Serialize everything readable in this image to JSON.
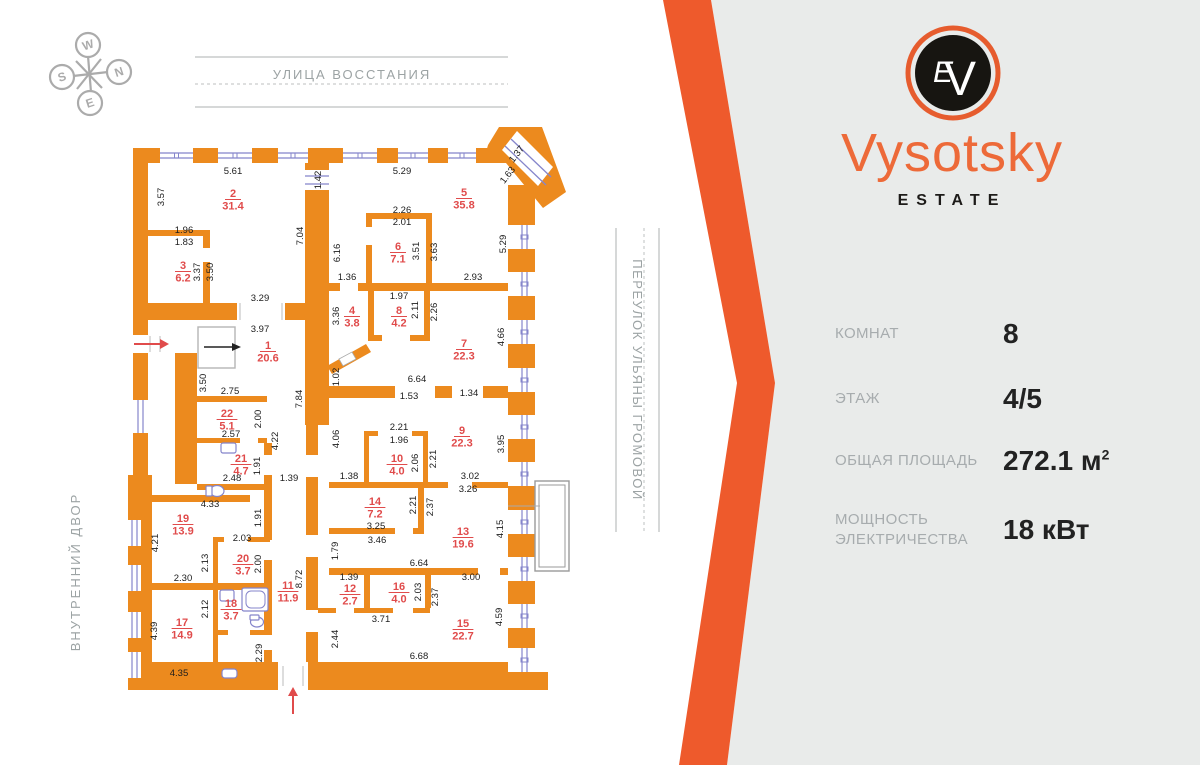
{
  "compass": {
    "letters": [
      "W",
      "N",
      "S",
      "E"
    ]
  },
  "streets": {
    "top": "УЛИЦА ВОССТАНИЯ",
    "right": "ПЕРЕУЛОК УЛЬЯНЫ ГРОМОВОЙ",
    "left": "ВНУТРЕННИЙ ДВОР"
  },
  "brand": {
    "name": "Vysotsky",
    "subtitle": "ESTATE",
    "monogram_v": "V",
    "monogram_e": "E"
  },
  "info": {
    "rows": [
      {
        "label": "КОМНАТ",
        "value": "8",
        "sup": ""
      },
      {
        "label": "ЭТАЖ",
        "value": "4/5",
        "sup": ""
      },
      {
        "label": "ОБЩАЯ ПЛОЩАДЬ",
        "value": "272.1 м",
        "sup": "2"
      },
      {
        "label": "МОЩНОСТЬ ЭЛЕКТРИЧЕСТВА",
        "value": "18 кВт",
        "sup": ""
      }
    ]
  },
  "colors": {
    "wall_orange": "#EC8A1E",
    "chevron_orange": "#EE5A2C",
    "brand_orange": "#ED6A39",
    "panel_gray": "#E9EBEA",
    "room_red": "#E04B4B",
    "window_blue": "#8585CB",
    "muted_gray": "#9CA3A4"
  },
  "plan": {
    "rooms": [
      {
        "n": "1",
        "area": "20.6",
        "x": 268,
        "y": 349
      },
      {
        "n": "2",
        "area": "31.4",
        "x": 233,
        "y": 197
      },
      {
        "n": "3",
        "area": "6.2",
        "x": 183,
        "y": 269
      },
      {
        "n": "4",
        "area": "3.8",
        "x": 352,
        "y": 314
      },
      {
        "n": "5",
        "area": "35.8",
        "x": 464,
        "y": 196
      },
      {
        "n": "6",
        "area": "7.1",
        "x": 398,
        "y": 250
      },
      {
        "n": "7",
        "area": "22.3",
        "x": 464,
        "y": 347
      },
      {
        "n": "8",
        "area": "4.2",
        "x": 399,
        "y": 314
      },
      {
        "n": "9",
        "area": "22.3",
        "x": 462,
        "y": 434
      },
      {
        "n": "10",
        "area": "4.0",
        "x": 397,
        "y": 462
      },
      {
        "n": "11",
        "area": "11.9",
        "x": 288,
        "y": 589
      },
      {
        "n": "12",
        "area": "2.7",
        "x": 350,
        "y": 592
      },
      {
        "n": "13",
        "area": "19.6",
        "x": 463,
        "y": 535
      },
      {
        "n": "14",
        "area": "7.2",
        "x": 375,
        "y": 505
      },
      {
        "n": "15",
        "area": "22.7",
        "x": 463,
        "y": 627
      },
      {
        "n": "16",
        "area": "4.0",
        "x": 399,
        "y": 590
      },
      {
        "n": "17",
        "area": "14.9",
        "x": 182,
        "y": 626
      },
      {
        "n": "18",
        "area": "3.7",
        "x": 231,
        "y": 607
      },
      {
        "n": "19",
        "area": "13.9",
        "x": 183,
        "y": 522
      },
      {
        "n": "20",
        "area": "3.7",
        "x": 243,
        "y": 562
      },
      {
        "n": "21",
        "area": "4.7",
        "x": 241,
        "y": 462
      },
      {
        "n": "22",
        "area": "5.1",
        "x": 227,
        "y": 417
      }
    ],
    "dims": [
      {
        "t": "5.61",
        "x": 233,
        "y": 174
      },
      {
        "t": "3.57",
        "x": 164,
        "y": 197,
        "r": -90
      },
      {
        "t": "1.42",
        "x": 321,
        "y": 180,
        "r": -90
      },
      {
        "t": "5.29",
        "x": 402,
        "y": 174
      },
      {
        "t": "1.37",
        "x": 519,
        "y": 156,
        "r": -52
      },
      {
        "t": "1.63",
        "x": 510,
        "y": 177,
        "r": -52
      },
      {
        "t": "2.26",
        "x": 402,
        "y": 213
      },
      {
        "t": "2.01",
        "x": 402,
        "y": 225
      },
      {
        "t": "5.29",
        "x": 506,
        "y": 244,
        "r": -90
      },
      {
        "t": "1.96",
        "x": 184,
        "y": 233
      },
      {
        "t": "1.83",
        "x": 184,
        "y": 245
      },
      {
        "t": "6.16",
        "x": 340,
        "y": 253,
        "r": -90
      },
      {
        "t": "7.04",
        "x": 303,
        "y": 236,
        "r": -90
      },
      {
        "t": "3.51",
        "x": 419,
        "y": 251,
        "r": -90
      },
      {
        "t": "3.63",
        "x": 437,
        "y": 252,
        "r": -90
      },
      {
        "t": "3.37",
        "x": 200,
        "y": 272,
        "r": -90
      },
      {
        "t": "3.50",
        "x": 213,
        "y": 272,
        "r": -90
      },
      {
        "t": "1.36",
        "x": 347,
        "y": 280
      },
      {
        "t": "2.93",
        "x": 473,
        "y": 280
      },
      {
        "t": "1.97",
        "x": 399,
        "y": 299
      },
      {
        "t": "3.29",
        "x": 260,
        "y": 301
      },
      {
        "t": "3.97",
        "x": 260,
        "y": 332
      },
      {
        "t": "3.36",
        "x": 339,
        "y": 316,
        "r": -90
      },
      {
        "t": "2.11",
        "x": 418,
        "y": 310,
        "r": -90
      },
      {
        "t": "2.26",
        "x": 437,
        "y": 312,
        "r": -90
      },
      {
        "t": "4.66",
        "x": 504,
        "y": 337,
        "r": -90
      },
      {
        "t": "1.02",
        "x": 339,
        "y": 377,
        "r": -90
      },
      {
        "t": "6.64",
        "x": 417,
        "y": 382
      },
      {
        "t": "1.53",
        "x": 409,
        "y": 399
      },
      {
        "t": "1.34",
        "x": 469,
        "y": 396
      },
      {
        "t": "3.50",
        "x": 206,
        "y": 383,
        "r": -90
      },
      {
        "t": "7.84",
        "x": 302,
        "y": 399,
        "r": -90
      },
      {
        "t": "2.75",
        "x": 230,
        "y": 394
      },
      {
        "t": "2.00",
        "x": 261,
        "y": 419,
        "r": -90
      },
      {
        "t": "2.57",
        "x": 231,
        "y": 437
      },
      {
        "t": "4.22",
        "x": 278,
        "y": 441,
        "r": -90
      },
      {
        "t": "4.06",
        "x": 339,
        "y": 439,
        "r": -90
      },
      {
        "t": "2.21",
        "x": 399,
        "y": 430
      },
      {
        "t": "1.96",
        "x": 399,
        "y": 443
      },
      {
        "t": "3.95",
        "x": 504,
        "y": 444,
        "r": -90
      },
      {
        "t": "2.06",
        "x": 418,
        "y": 463,
        "r": -90
      },
      {
        "t": "2.21",
        "x": 436,
        "y": 459,
        "r": -90
      },
      {
        "t": "1.91",
        "x": 260,
        "y": 466,
        "r": -90
      },
      {
        "t": "2.48",
        "x": 232,
        "y": 481
      },
      {
        "t": "1.39",
        "x": 289,
        "y": 481
      },
      {
        "t": "1.38",
        "x": 349,
        "y": 479
      },
      {
        "t": "3.02",
        "x": 470,
        "y": 479
      },
      {
        "t": "3.26",
        "x": 468,
        "y": 492
      },
      {
        "t": "4.33",
        "x": 210,
        "y": 507
      },
      {
        "t": "1.91",
        "x": 261,
        "y": 518,
        "r": -90
      },
      {
        "t": "2.21",
        "x": 416,
        "y": 505,
        "r": -90
      },
      {
        "t": "2.37",
        "x": 433,
        "y": 507,
        "r": -90
      },
      {
        "t": "4.15",
        "x": 503,
        "y": 529,
        "r": -90
      },
      {
        "t": "4.21",
        "x": 158,
        "y": 543,
        "r": -90
      },
      {
        "t": "2.03",
        "x": 242,
        "y": 541
      },
      {
        "t": "2.13",
        "x": 208,
        "y": 563,
        "r": -90
      },
      {
        "t": "2.00",
        "x": 261,
        "y": 564,
        "r": -90
      },
      {
        "t": "3.25",
        "x": 376,
        "y": 529
      },
      {
        "t": "3.46",
        "x": 377,
        "y": 543
      },
      {
        "t": "1.79",
        "x": 338,
        "y": 551,
        "r": -90
      },
      {
        "t": "2.30",
        "x": 183,
        "y": 581
      },
      {
        "t": "8.72",
        "x": 302,
        "y": 579,
        "r": -90
      },
      {
        "t": "6.64",
        "x": 419,
        "y": 566
      },
      {
        "t": "1.39",
        "x": 349,
        "y": 580
      },
      {
        "t": "3.00",
        "x": 471,
        "y": 580
      },
      {
        "t": "2.03",
        "x": 421,
        "y": 592,
        "r": -90
      },
      {
        "t": "2.37",
        "x": 438,
        "y": 597,
        "r": -90
      },
      {
        "t": "2.12",
        "x": 208,
        "y": 609,
        "r": -90
      },
      {
        "t": "4.39",
        "x": 157,
        "y": 631,
        "r": -90
      },
      {
        "t": "4.59",
        "x": 502,
        "y": 617,
        "r": -90
      },
      {
        "t": "2.44",
        "x": 338,
        "y": 639,
        "r": -90
      },
      {
        "t": "3.71",
        "x": 381,
        "y": 622
      },
      {
        "t": "2.29",
        "x": 262,
        "y": 653,
        "r": -90
      },
      {
        "t": "4.35",
        "x": 179,
        "y": 676
      },
      {
        "t": "6.68",
        "x": 419,
        "y": 659
      }
    ]
  }
}
